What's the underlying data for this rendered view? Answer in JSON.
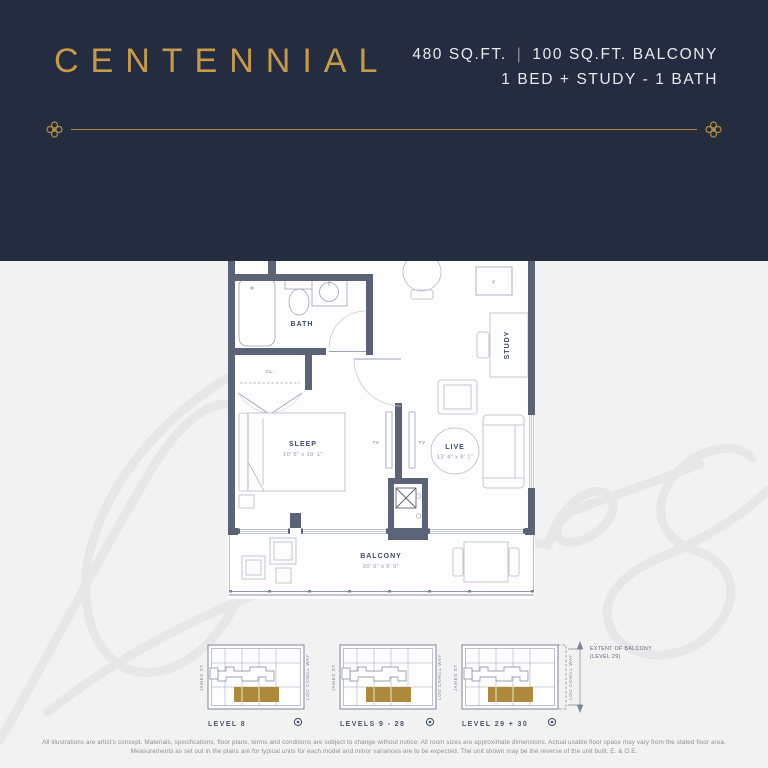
{
  "header": {
    "unit_name": "CENTENNIAL",
    "area": "480 SQ.FT.",
    "divider": "|",
    "balcony_area": "100 SQ.FT. BALCONY",
    "configuration": "1 BED + STUDY - 1 BATH"
  },
  "colors": {
    "navy": "#262c3f",
    "gold": "#c49a4c",
    "background": "#f3f2f3",
    "wall_slate": "#5b6377",
    "keyplan_unit_gold": "#ae8a3c"
  },
  "watermark_text": "James",
  "floorplan": {
    "rooms": {
      "cook_dine": {
        "name": "COOK / DINE",
        "dims": "8' 4\" x 9' 10\""
      },
      "bath": "BATH",
      "study": "STUDY",
      "sleep": {
        "name": "SLEEP",
        "dims": "10' 5\" x 10' 1\""
      },
      "live": {
        "name": "LIVE",
        "dims": "13' 4\" x 8' 1\""
      },
      "balcony": {
        "name": "BALCONY",
        "dims": "20' 0\" x 5' 0\""
      }
    },
    "fixtures": {
      "washer_dryer": "W/D",
      "dishwasher": "DW",
      "stove": "S",
      "fridge": "F",
      "closet_entry": "CL.",
      "closet_bedroom": "CL.",
      "tv_left": "TV",
      "tv_right": "TV"
    }
  },
  "keyplans": {
    "street_left": "JAMES ST.",
    "street_right": "LOU CAHILL WAY",
    "levels": [
      {
        "label": "LEVEL 8"
      },
      {
        "label": "LEVELS 9 - 28"
      },
      {
        "label": "LEVEL 29 + 30"
      }
    ],
    "note": {
      "line1": "EXTENT OF BALCONY",
      "line2": "(LEVEL 29)"
    }
  },
  "disclaimer": {
    "line1": "All illustrations are artist's concept. Materials, specifications, floor plans, terms and conditions are subject to change without notice. All room sizes are approximate dimensions. Actual usable floor space may vary from the stated floor area.",
    "line2": "Measurements as set out in the plans are for typical units for each model and minor variances are to be expected. The unit shown may be the reverse of the unit built. E. & O.E."
  }
}
